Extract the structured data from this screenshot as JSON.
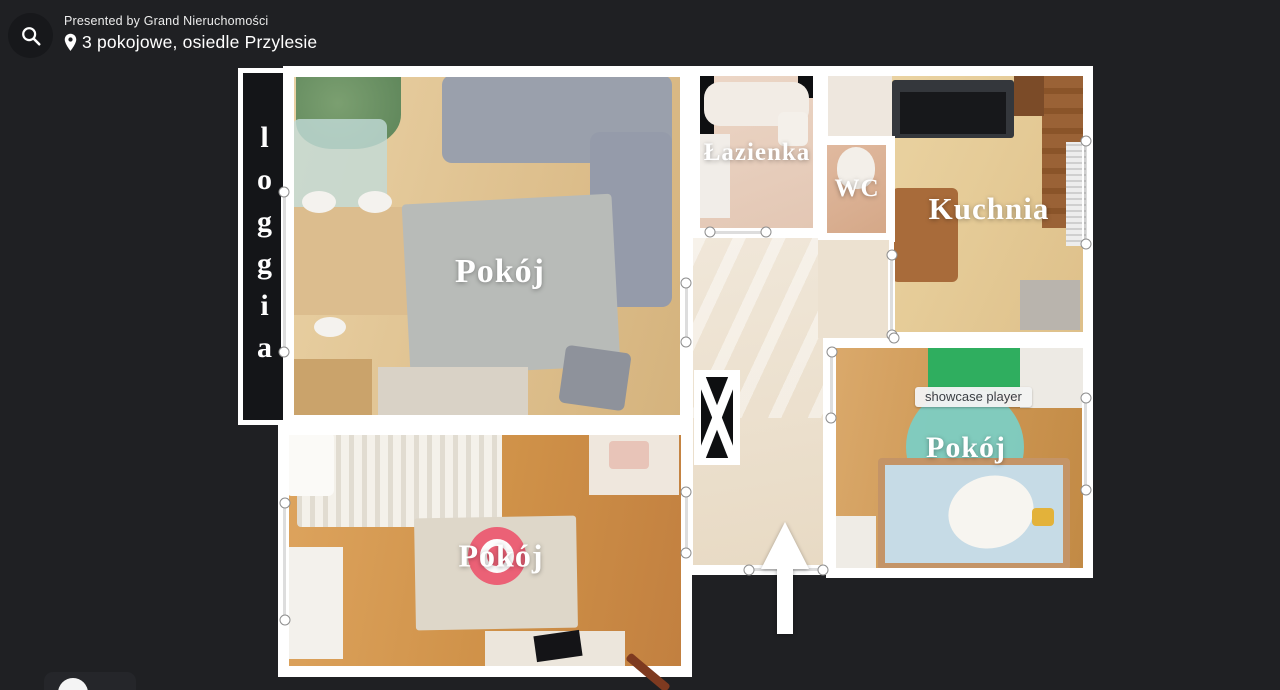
{
  "header": {
    "presented_by": "Presented by Grand Nieruchomości",
    "property_title": "3 pokojowe, osiedle Przylesie"
  },
  "floorplan": {
    "tooltip": "showcase player",
    "rooms": {
      "loggia": "loggia",
      "living_room": "Pokój",
      "bedroom": "Pokój",
      "kids_room": "Pokój",
      "bathroom": "Łazienka",
      "wc": "WC",
      "kitchen": "Kuchnia"
    }
  },
  "icons": {
    "search": "search-icon",
    "location": "location-pin-icon"
  },
  "colors": {
    "background": "#1f2023",
    "walls": "#ffffff",
    "viewpoint_marker": "#ec5b72",
    "tooltip_bg": "#f2f2f2",
    "tooltip_text": "#3b3f44",
    "kids_rug": "#7ccdc3",
    "wardrobe_green": "#2fae5f"
  }
}
